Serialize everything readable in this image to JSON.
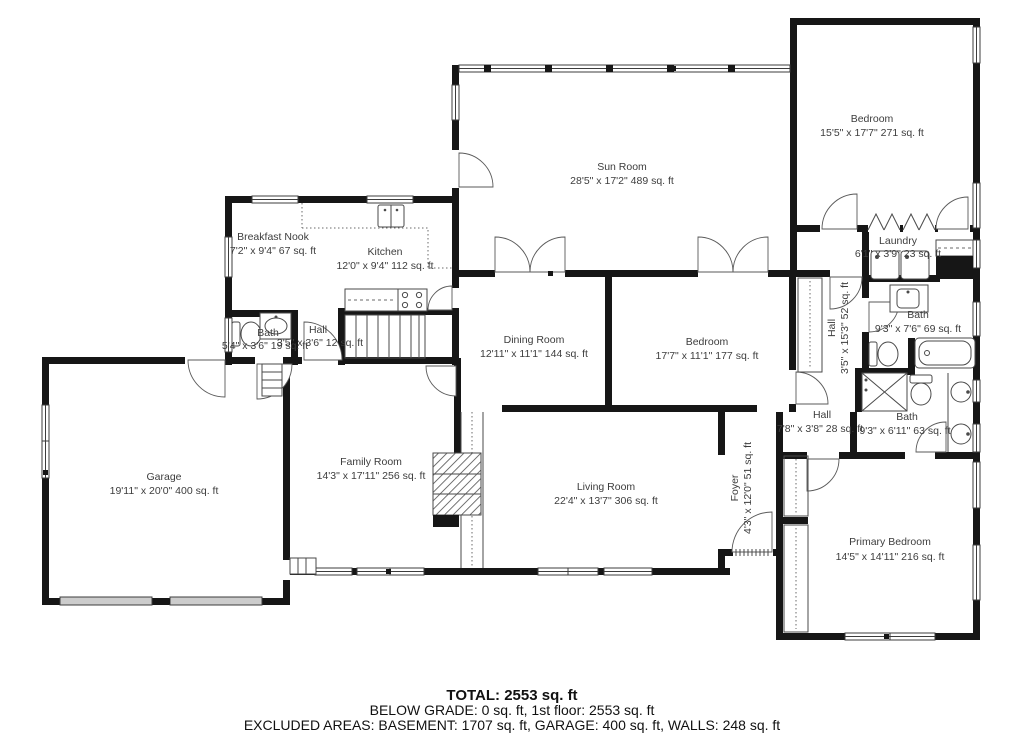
{
  "colors": {
    "wall": "#161616",
    "label_text": "#3d3d3d",
    "garage_door": "#cccccc",
    "background": "#ffffff"
  },
  "rooms": {
    "bedroom_top": {
      "name": "Bedroom",
      "dims": "15'5\" x 17'7\" 271 sq. ft"
    },
    "sun_room": {
      "name": "Sun Room",
      "dims": "28'5\" x 17'2\" 489 sq. ft"
    },
    "breakfast_nook": {
      "name": "Breakfast Nook",
      "dims": "7'2\" x 9'4\" 67 sq. ft"
    },
    "kitchen": {
      "name": "Kitchen",
      "dims": "12'0\" x 9'4\" 112 sq. ft"
    },
    "laundry": {
      "name": "Laundry",
      "dims": "6'1\" x 3'9\" 23 sq. ft"
    },
    "bath_upper": {
      "name": "Bath",
      "dims": "9'3\" x 7'6\" 69 sq. ft"
    },
    "hall_main": {
      "name": "Hall",
      "dims": "3'5\" x 15'3\" 52 sq. ft"
    },
    "dining_room": {
      "name": "Dining Room",
      "dims": "12'11\" x 11'1\" 144 sq. ft"
    },
    "bedroom_mid": {
      "name": "Bedroom",
      "dims": "17'7\" x 11'1\" 177 sq. ft"
    },
    "bath_small": {
      "name": "Bath",
      "dims": "5'4\" x 3'6\" 19 sq. ft"
    },
    "hall_small": {
      "name": "Hall",
      "dims": "3'5\" x 3'6\" 12 sq. ft"
    },
    "garage": {
      "name": "Garage",
      "dims": "19'11\" x 20'0\" 400 sq. ft"
    },
    "family_room": {
      "name": "Family Room",
      "dims": "14'3\" x 17'11\" 256 sq. ft"
    },
    "living_room": {
      "name": "Living Room",
      "dims": "22'4\" x 13'7\" 306 sq. ft"
    },
    "foyer": {
      "name": "Foyer",
      "dims": "4'3\" x 12'0\" 51 sq. ft"
    },
    "hall_lower": {
      "name": "Hall",
      "dims": "7'8\" x 3'8\" 28 sq. ft"
    },
    "bath_lower": {
      "name": "Bath",
      "dims": "9'3\" x 6'11\" 63 sq. ft"
    },
    "primary_bedroom": {
      "name": "Primary Bedroom",
      "dims": "14'5\" x 14'11\" 216 sq. ft"
    }
  },
  "summary": {
    "total": "TOTAL: 2553 sq. ft",
    "below_grade": "BELOW GRADE: 0 sq. ft, 1st floor: 2553 sq. ft",
    "excluded": "EXCLUDED AREAS: BASEMENT: 1707 sq. ft, GARAGE: 400 sq. ft, WALLS: 248 sq. ft"
  }
}
